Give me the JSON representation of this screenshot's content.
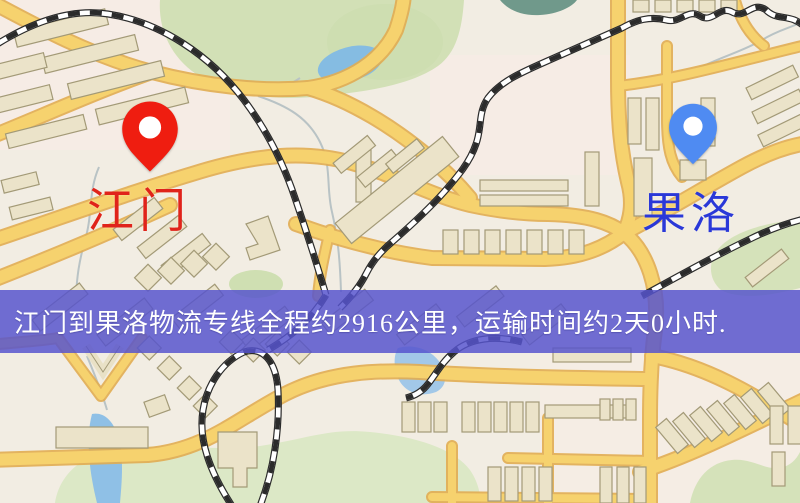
{
  "route_map": {
    "origin": {
      "name": "江门",
      "label_color": "#e0231a",
      "pin_color": "#ef1d10"
    },
    "destination": {
      "name": "果洛",
      "label_color": "#2a38d8",
      "pin_color": "#4f8bf2"
    },
    "banner": {
      "text": "江门到果洛物流专线全程约2916公里，运输时间约2天0小时.",
      "distance": "2916公里",
      "duration": "2天0小时",
      "background": "#5a58cd",
      "text_color": "#ffffff"
    },
    "palette": {
      "map_background": "#f2ede3",
      "road_fill": "#f6d26e",
      "road_casing": "#e2ad52",
      "park_green": "#d5e2ba",
      "water_blue": "#8fc0e6",
      "pond_teal": "#70998b",
      "building_fill": "#ebe3c9",
      "building_stroke": "#a39a77",
      "railway_black": "#2b2b2b"
    }
  }
}
